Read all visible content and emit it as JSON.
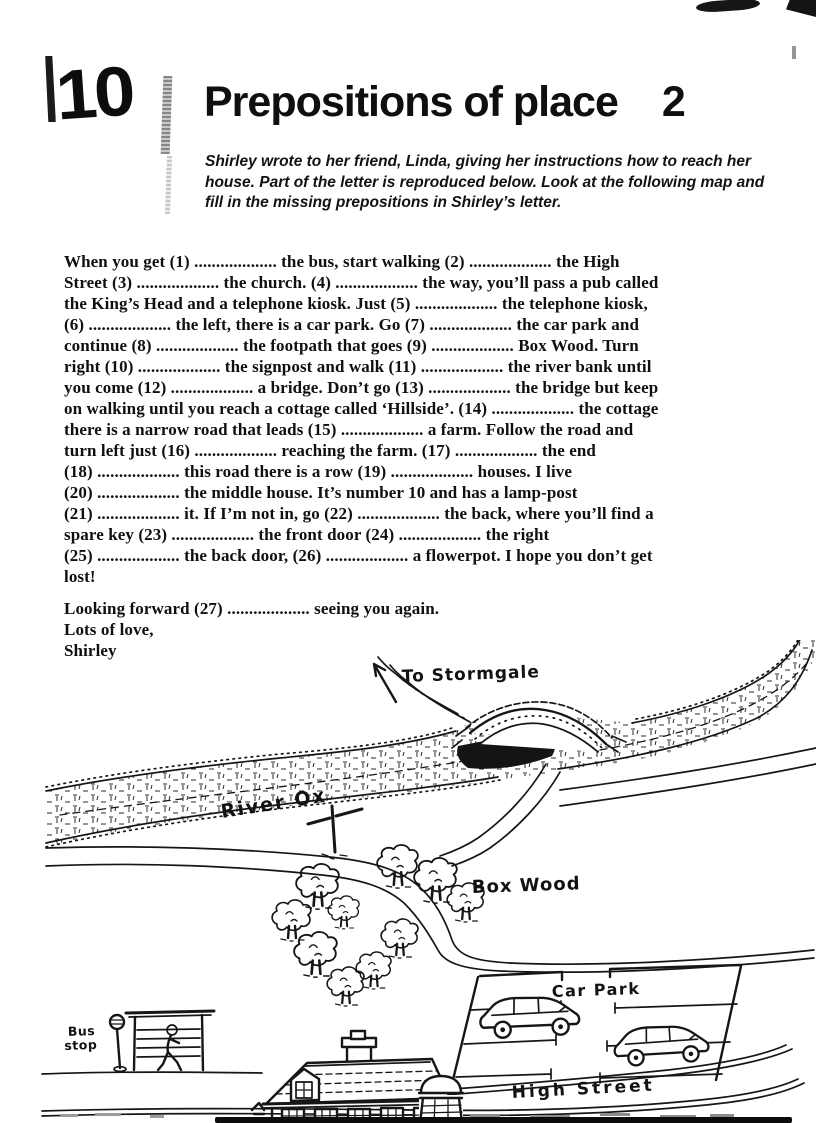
{
  "page": {
    "unit_number": "10",
    "title": "Prepositions of place",
    "title_suffix": "2",
    "instructions_lines": [
      "Shirley wrote to her friend, Linda, giving her instructions how to reach her",
      "house. Part of the letter is reproduced below. Look at the following map and",
      "fill in the missing prepositions in Shirley’s letter."
    ]
  },
  "letter": {
    "lines": [
      "When you get (1) ................... the bus, start walking (2) ................... the High",
      "Street (3) ................... the church. (4) ................... the way, you’ll pass a pub called",
      "the King’s Head and a telephone kiosk. Just (5) ................... the telephone kiosk,",
      "(6) ................... the left, there is a car park. Go (7) ................... the car park and",
      "continue (8) ................... the footpath that goes (9) ................... Box Wood. Turn",
      "right (10) ................... the signpost and walk (11) ................... the river bank until",
      "you come (12) ................... a bridge. Don’t go (13) ................... the bridge but keep",
      "on walking until you reach a cottage called ‘Hillside’. (14) ................... the cottage",
      "there is a narrow road that leads (15) ................... a farm. Follow the road and",
      "turn left just (16) ................... reaching the farm. (17) ................... the end",
      "(18) ................... this road there is a row (19) ................... houses. I live",
      "(20) ................... the middle house. It’s number 10 and has a lamp-post",
      "(21) ................... it. If I’m not in, go (22) ................... the back, where you’ll find a",
      "spare key (23) ................... the front door (24) ................... the right",
      "(25) ................... the back door, (26) ................... a flowerpot. I hope you don’t get",
      "lost!"
    ],
    "closing_lines": [
      "Looking forward (27) ................... seeing you again.",
      "Lots of love,",
      "Shirley"
    ]
  },
  "map": {
    "labels": {
      "stormgale": "To Stormgale",
      "river": "River Ox",
      "wood": "Box Wood",
      "car_park": "Car Park",
      "high_street": "High Street",
      "bus_stop_line1": "Bus",
      "bus_stop_line2": "stop"
    }
  },
  "colors": {
    "ink": "#161616",
    "paper": "#ffffff"
  }
}
